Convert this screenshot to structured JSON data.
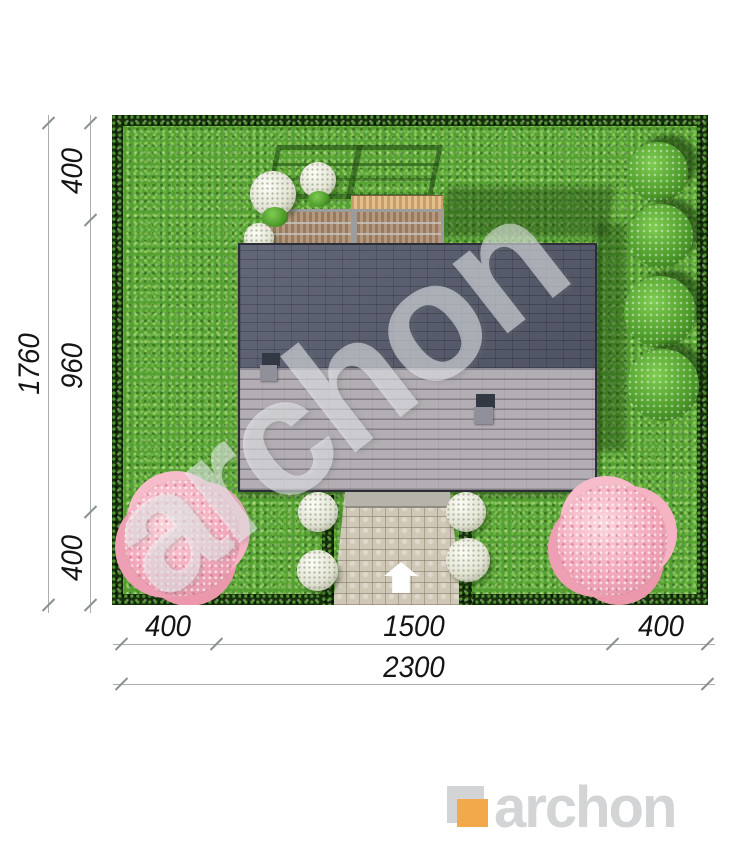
{
  "drawing": {
    "kind": "house-site-plan-top-view"
  },
  "dimensions": {
    "left_total": "1760",
    "left_segments": [
      "400",
      "960",
      "400"
    ],
    "bottom_segments": [
      "400",
      "1500",
      "400"
    ],
    "bottom_total": "2300"
  },
  "watermark": {
    "text": "archon"
  },
  "logo": {
    "wordmark": "archon"
  },
  "icons": {
    "entrance_arrow": "up-arrow"
  },
  "colors": {
    "grass": "#55a032",
    "hedge": "#17310c",
    "roof_dark_slope": "#575c6e",
    "roof_light_slope": "#b3aeb4",
    "deck_wood": "#e2c08c",
    "wall_wood": "#b59a80",
    "path_stone": "#d0c8b6",
    "blossom_tree": "#f2a8ba",
    "bush_green": "#4d9a2a",
    "shadow_green": "#163a0a",
    "dimension_line": "#a9aeae",
    "dimension_text": "#141414",
    "logo_gray": "#d2d4d6",
    "logo_orange": "#f2a94b",
    "watermark_tint": "#f4f6f9"
  }
}
